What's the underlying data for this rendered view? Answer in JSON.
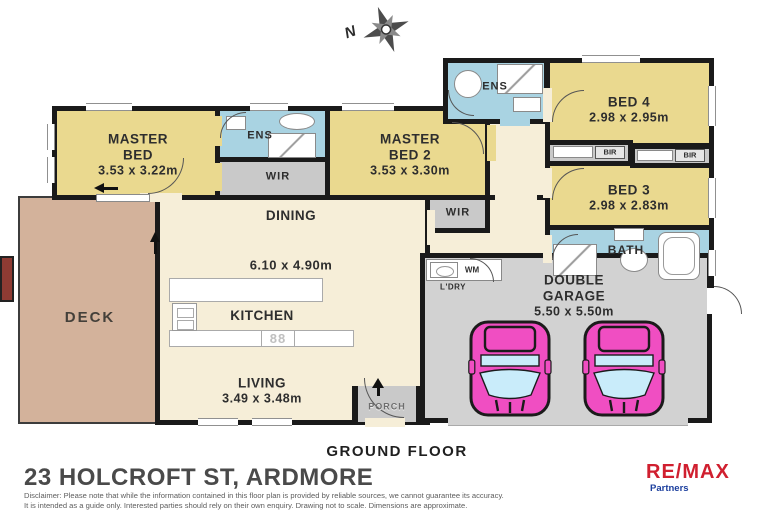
{
  "page": {
    "title": "23 HOLCROFT ST, ARDMORE",
    "floor_label": "GROUND FLOOR"
  },
  "compass": {
    "north": "N"
  },
  "logo": {
    "brand": "RE/MAX",
    "sub": "Partners"
  },
  "disclaimer": {
    "line1": "Disclaimer: Please note that while the information contained in this floor plan is provided by reliable sources, we cannot guarantee its accuracy.",
    "line2": "It is intended as a guide only. Interested parties should rely on their own enquiry. Drawing not to scale.  Dimensions are approximate."
  },
  "rooms": {
    "master_bed": {
      "label": "MASTER BED",
      "dims": "3.53 x 3.22m"
    },
    "ens1": {
      "label": "ENS"
    },
    "wir1": {
      "label": "WIR"
    },
    "master_bed2": {
      "label": "MASTER BED 2",
      "dims": "3.53 x 3.30m"
    },
    "ens2": {
      "label": "ENS"
    },
    "bed4": {
      "label": "BED 4",
      "dims": "2.98 x 2.95m"
    },
    "bir1": {
      "label": "BIR"
    },
    "bir2": {
      "label": "BIR"
    },
    "bed3": {
      "label": "BED 3",
      "dims": "2.98 x 2.83m"
    },
    "bath": {
      "label": "BATH"
    },
    "wir2": {
      "label": "WIR"
    },
    "dining": {
      "label": "DINING",
      "dims": "6.10 x 4.90m"
    },
    "kitchen": {
      "label": "KITCHEN"
    },
    "deck": {
      "label": "DECK"
    },
    "living": {
      "label": "LIVING",
      "dims": "3.49 x 3.48m"
    },
    "porch": {
      "label": "PORCH"
    },
    "laundry": {
      "label": "L'DRY",
      "appliance": "WM"
    },
    "garage": {
      "label": "DOUBLE GARAGE",
      "dims": "5.50 x 5.50m"
    }
  },
  "icons": {
    "cooktop_glyph": "88"
  },
  "colors": {
    "bedroom_fill": "#ead98f",
    "wet_area_fill": "#a9d3e2",
    "robe_fill": "#c9c9c9",
    "living_fill": "#f6eed8",
    "deck_fill": "#d3b29b",
    "garage_fill": "#d2d2d2",
    "car_pink": "#f04ec2",
    "wall_black": "#1a1a1a",
    "brand_red": "#d01f2f",
    "brand_blue": "#1c3f9e"
  }
}
